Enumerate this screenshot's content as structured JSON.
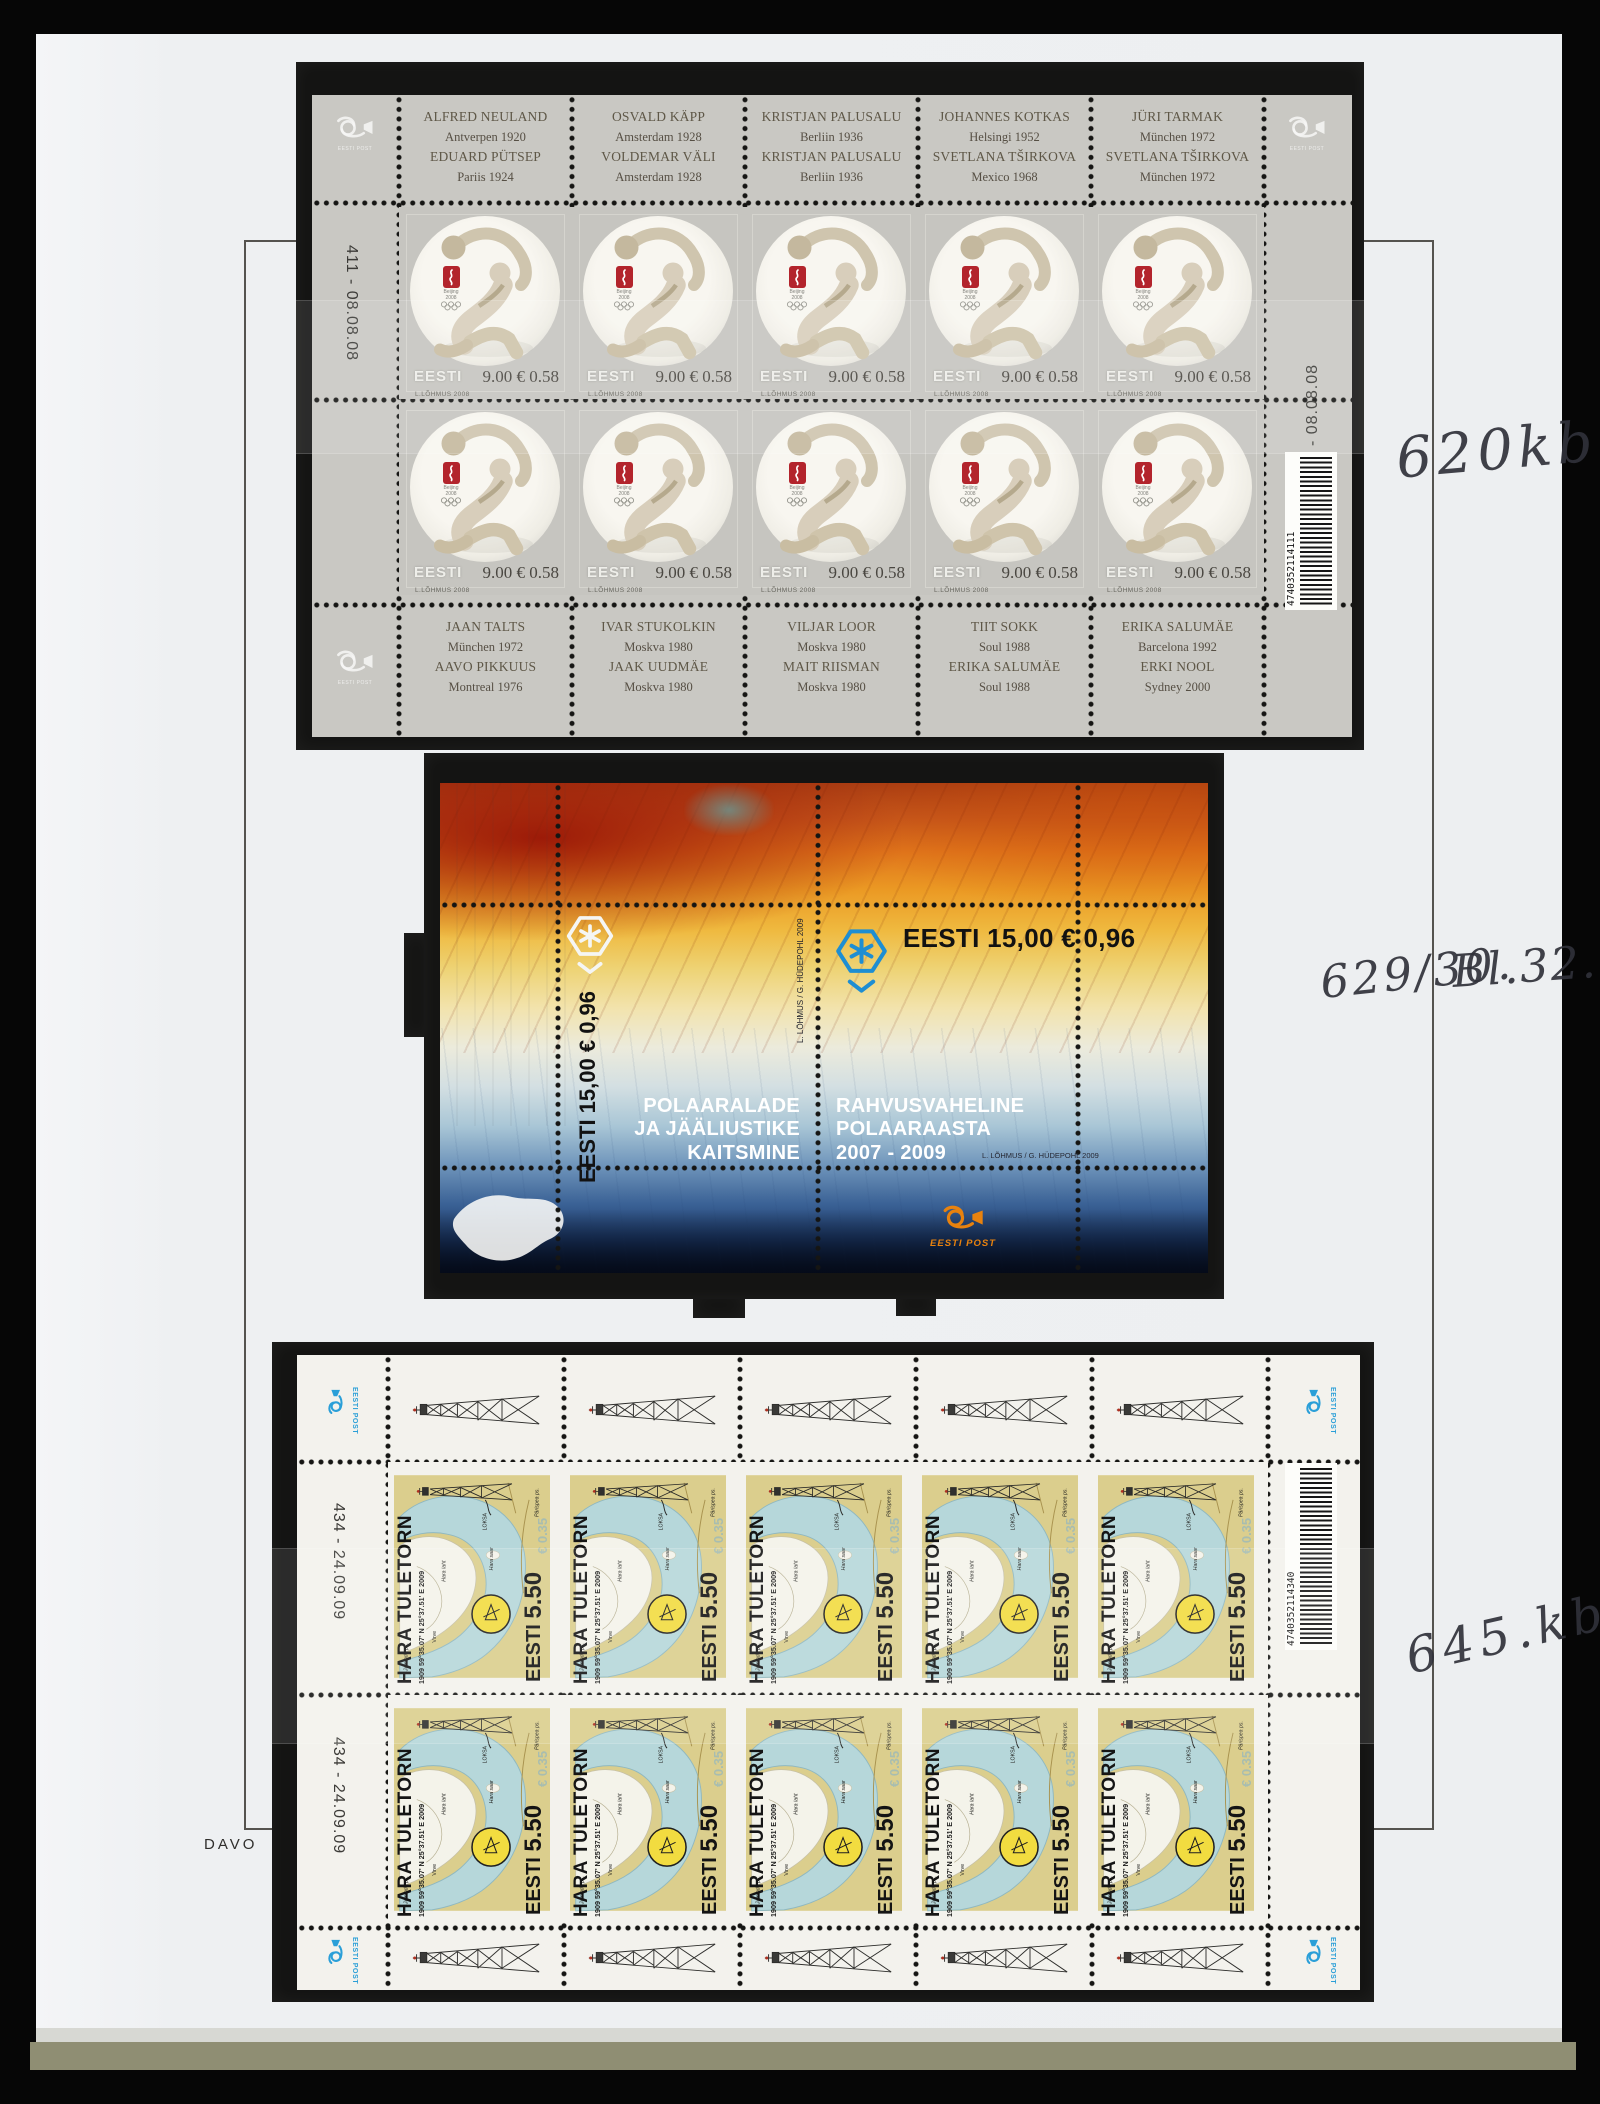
{
  "page": {
    "brand": "DAVO"
  },
  "annotations": {
    "a1": "620kb",
    "a2": "629/30.",
    "a2b": "Bl.32.",
    "a3": "645.kb"
  },
  "post_logo": "EESTI POST",
  "sheet1": {
    "plate_number": "411 - 08.08.08",
    "barcode_digits": "4740352114111",
    "stamp": {
      "country": "EESTI",
      "value": "9.00 € 0.58",
      "credit": "L.LÕHMUS 2008"
    },
    "top_labels": [
      {
        "l1": "ALFRED NEULAND",
        "l2": "Antverpen 1920",
        "l3": "EDUARD PÜTSEP",
        "l4": "Pariis 1924"
      },
      {
        "l1": "OSVALD KÄPP",
        "l2": "Amsterdam 1928",
        "l3": "VOLDEMAR VÄLI",
        "l4": "Amsterdam 1928"
      },
      {
        "l1": "KRISTJAN PALUSALU",
        "l2": "Berliin 1936",
        "l3": "KRISTJAN PALUSALU",
        "l4": "Berliin 1936"
      },
      {
        "l1": "JOHANNES KOTKAS",
        "l2": "Helsingi 1952",
        "l3": "SVETLANA TŠIRKOVA",
        "l4": "Mexico 1968"
      },
      {
        "l1": "JÜRI TARMAK",
        "l2": "München 1972",
        "l3": "SVETLANA TŠIRKOVA",
        "l4": "München 1972"
      }
    ],
    "bottom_labels": [
      {
        "l1": "JAAN TALTS",
        "l2": "München 1972",
        "l3": "AAVO PIKKUUS",
        "l4": "Montreal 1976"
      },
      {
        "l1": "IVAR STUKOLKIN",
        "l2": "Moskva 1980",
        "l3": "JAAK UUDMÄE",
        "l4": "Moskva 1980"
      },
      {
        "l1": "VILJAR LOOR",
        "l2": "Moskva 1980",
        "l3": "MAIT RIISMAN",
        "l4": "Moskva 1980"
      },
      {
        "l1": "TIIT SOKK",
        "l2": "Soul 1988",
        "l3": "ERIKA SALUMÄE",
        "l4": "Soul 1988"
      },
      {
        "l1": "ERIKA SALUMÄE",
        "l2": "Barcelona 1992",
        "l3": "ERKI NOOL",
        "l4": "Sydney 2000"
      }
    ]
  },
  "sheet2": {
    "value_text": "EESTI 15,00 € 0,96",
    "left_caption": [
      "POLAARALADE",
      "JA JÄÄLIUSTIKE",
      "KAITSMINE"
    ],
    "right_caption": [
      "RAHVUSVAHELINE",
      "POLAARAASTA",
      "2007 - 2009"
    ],
    "credit": "L. LÕHMUS / G. HÜDEPOHL 2009"
  },
  "sheet3": {
    "plate_number": "434 - 24.09.09",
    "barcode_digits": "4740352114340",
    "stamp": {
      "title": "HARA TULETORN",
      "years_coords": "1909  59°35.07' N   25°37.51' E  2009",
      "country": "EESTI",
      "value": "5.50",
      "euro_ghost": "€ 0.35",
      "map_label_1": "LOKSA",
      "map_label_2": "Hara laht",
      "map_label_3": "Hara saar",
      "map_label_4": "Virve",
      "map_label_5": "Juminda ps.",
      "map_label_6": "Pärispea ps."
    }
  }
}
